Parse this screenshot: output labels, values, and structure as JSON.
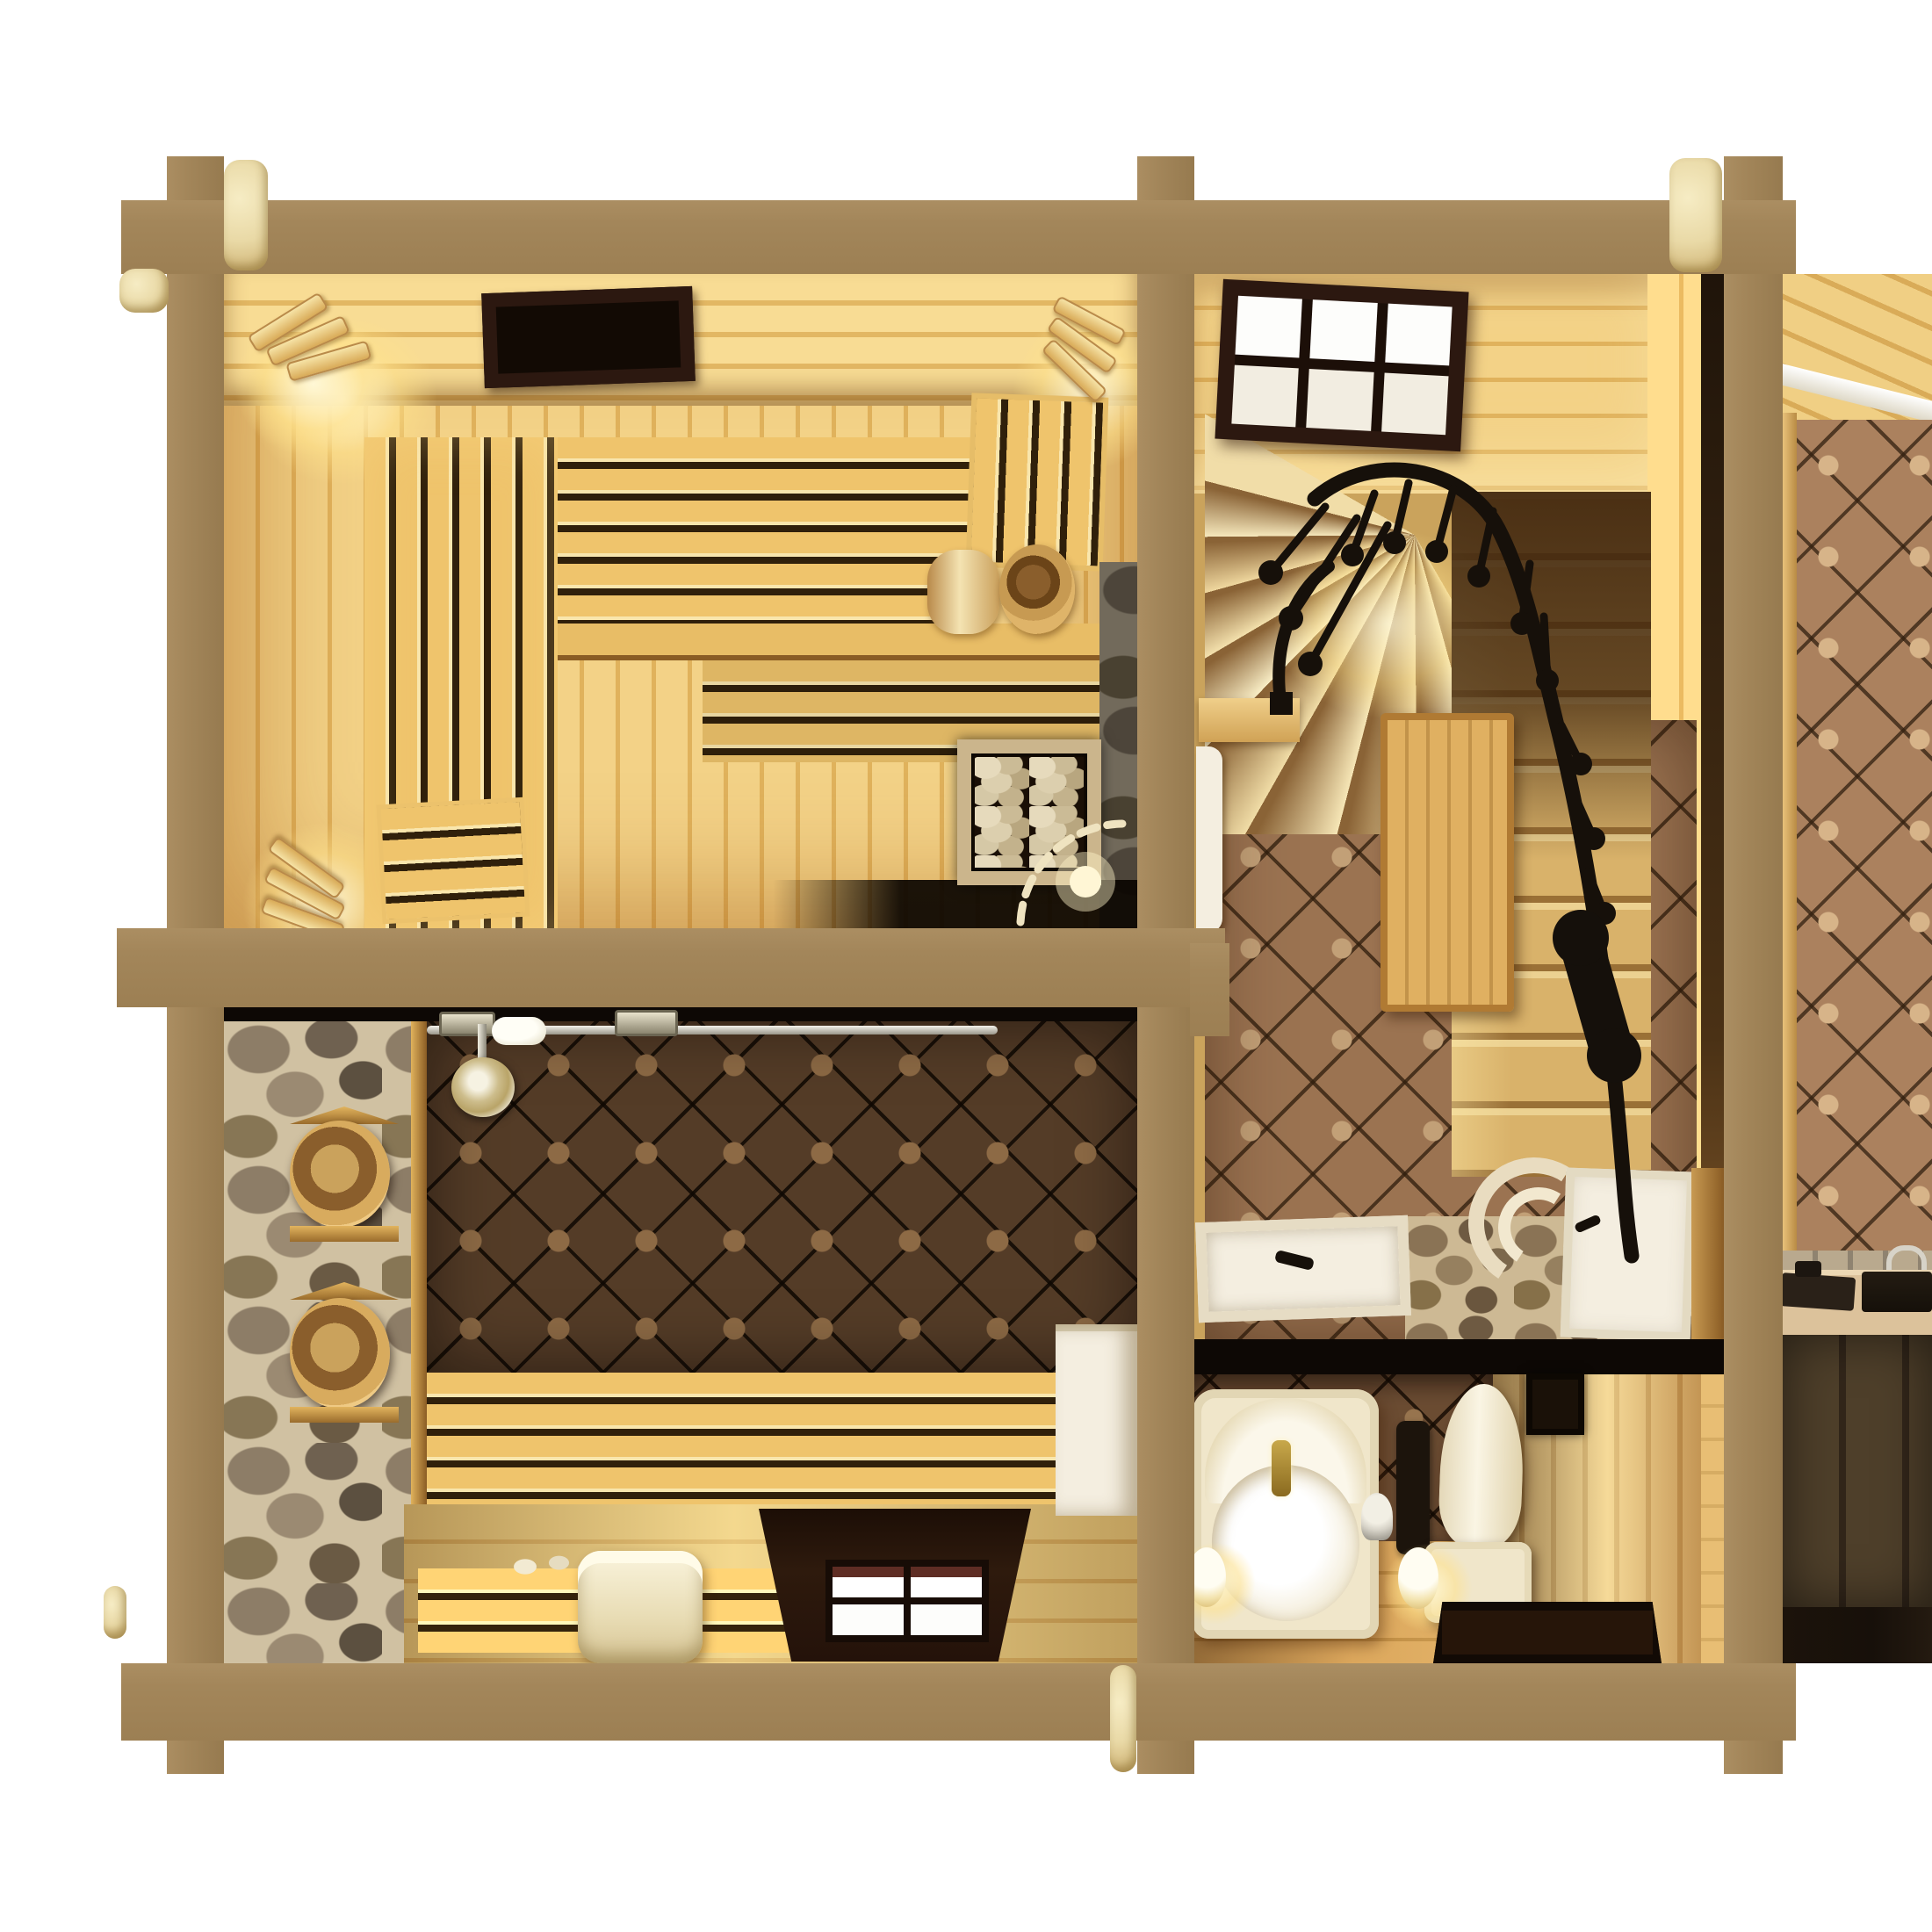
{
  "scene": {
    "title": "Top-down 3D cutaway render of a log bathhouse floor plan",
    "background": "plain white, no text or UI controls",
    "structure": {
      "label": "Squared tan log frame seen in section",
      "elements": [
        "top beam",
        "middle beam",
        "bottom beam",
        "left post",
        "middle post",
        "right post",
        "cream sawn log ends at the joints"
      ]
    },
    "rooms": [
      {
        "id": "sauna",
        "label": "Sauna (top left) with warm glowing wood",
        "objects": [
          "dark ceiling vent",
          "three curved slat wall lamps",
          "vertical-slat side bench",
          "horizontal-slat upper bench",
          "corner duckboard rack",
          "backrest rack",
          "rolled towel",
          "round wooden bucket",
          "stone-framed heater filled with pebbles",
          "dark stone wall strip",
          "door swing arc with small glowing lamp"
        ]
      },
      {
        "id": "stair-hall",
        "label": "Hall with winder staircase (top right)",
        "objects": [
          "dark-framed six-pane window",
          "fanned winder treads",
          "straight stair flight with dark upper steps",
          "black wrought-iron handrail and balusters",
          "black newel post",
          "vertical-plank stair box",
          "small wall shelf",
          "white side door leaf",
          "white bottom door with curved cream steps",
          "white shower tray with black handle",
          "pebble stone floor patch",
          "octagon tile floor",
          "black floor divider"
        ]
      },
      {
        "id": "washroom",
        "label": "Washroom (bottom left)",
        "objects": [
          "rubble stone wall",
          "two wooden buckets on triangular shelves",
          "chrome pipework with ornate valves",
          "chrome shower head",
          "dark octagon tile wall",
          "horizontal-slat wall bench",
          "lower slat bench with white pebbles",
          "rolled cream towel",
          "recessed four-pane window with maroon blind",
          "white shelf cabinet",
          "light plank floor"
        ]
      },
      {
        "id": "bathroom",
        "label": "Bathroom (bottom centre-right)",
        "objects": [
          "cream bathtub with arched back and gold faucet",
          "black towel radiator",
          "small round vanity mirror",
          "toilet with elongated lid and cistern",
          "dark wall-mounted window",
          "two glowing globe sconces",
          "dark square basin",
          "warm plank floor",
          "lit vertical plank wall"
        ]
      },
      {
        "id": "side-room",
        "label": "Partially visible side room (far right)",
        "objects": [
          "diagonal plank ceiling with white cornice",
          "octagon tile wall",
          "counter with dark sink, dark hob and chrome faucet",
          "dark base cabinets",
          "dark stone floor"
        ]
      }
    ]
  },
  "colors": {
    "white": "#ffffff",
    "beam": "#a3865a",
    "logend": "#e9d9a6",
    "blackline": "#0d0805",
    "slatgap": "#30200b",
    "bench1": "#efc46c",
    "darkframe": "#2c1810",
    "tilelightbase": "#9b7351",
    "tilelightdot": "#c2a077",
    "tiledarkbase": "#543c27",
    "tiledarkdot": "#8d6a45",
    "stonegrout": "#cdb994",
    "rail": "#16100a",
    "whitedoor": "#f4eee0",
    "cream": "#f0e6ca",
    "gold": "#c8a84b",
    "chrome": "#d7d3c8",
    "woodbox": "#d9a858",
    "woodfloor": "#d89f52",
    "cabinetdark": "#4e3f2a",
    "marbledark": "#17100a",
    "counter": "#dcc29b",
    "maroon": "#5e2d24",
    "radiator": "#1c140c"
  }
}
